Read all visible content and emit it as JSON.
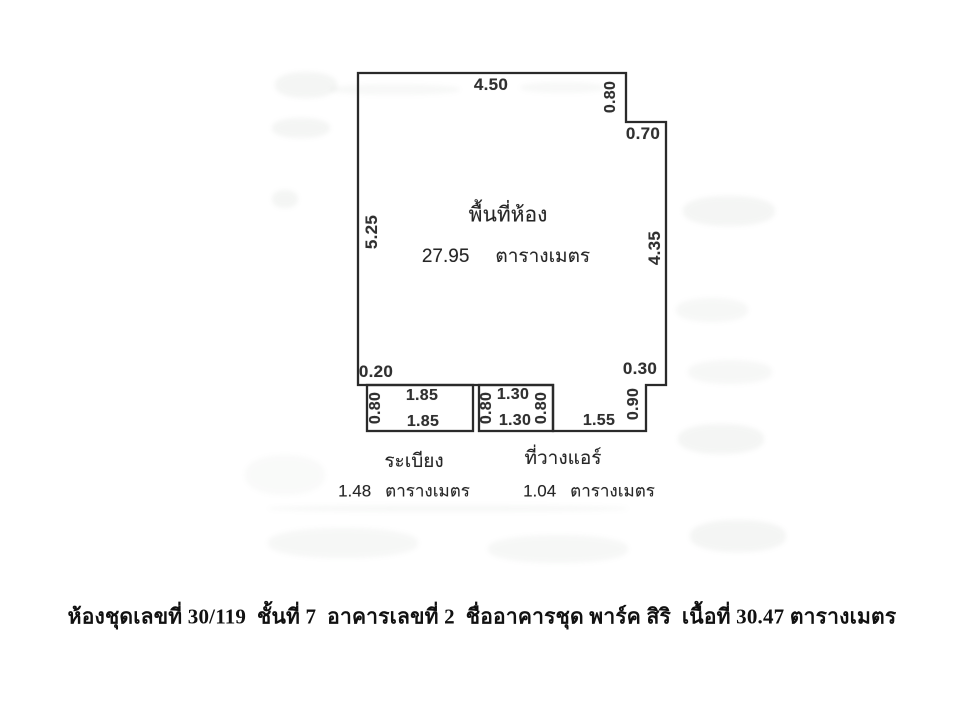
{
  "document": {
    "background_color": "#ffffff",
    "ink_color": "#2a2a2a",
    "caption": "ห้องชุดเลขที่ 30/119  ชั้นที่ 7  อาคารเลขที่ 2  ชื่ออาคารชุด พาร์ค สิริ  เนื้อที่ 30.47 ตารางเมตร"
  },
  "plan": {
    "room": {
      "label": "พื้นที่ห้อง",
      "area_value": "27.95",
      "area_unit": "ตารางเมตร"
    },
    "balcony": {
      "label": "ระเบียง",
      "area_value": "1.48",
      "area_unit": "ตารางเมตร"
    },
    "ac_shelf": {
      "label": "ที่วางแอร์",
      "area_value": "1.04",
      "area_unit": "ตารางเมตร"
    },
    "dimensions": {
      "top_width": "4.50",
      "upper_right_notch_depth": "0.80",
      "upper_right_notch_width": "0.70",
      "left_height": "5.25",
      "right_height": "4.35",
      "bottom_left_inset": "0.20",
      "bottom_right_inset": "0.30",
      "balcony_depth": "0.80",
      "balcony_top_width": "1.85",
      "balcony_bottom_width": "1.85",
      "ac_left_depth": "0.80",
      "ac_top_width": "1.30",
      "ac_bottom_width": "1.30",
      "ac_right_depth": "0.80",
      "ledge_bottom_width": "1.55",
      "ledge_right_depth": "0.90"
    }
  }
}
